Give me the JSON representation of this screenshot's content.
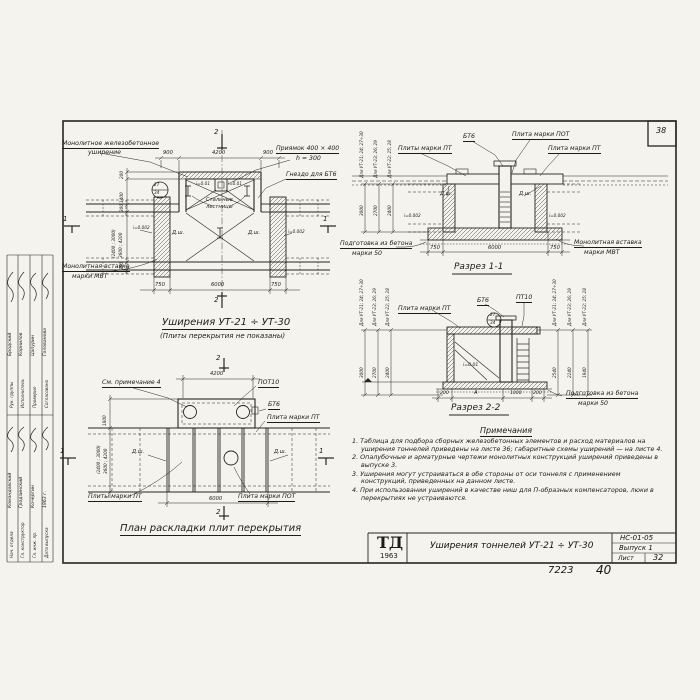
{
  "frame": {
    "corner_number": "38"
  },
  "titleblock": {
    "logo": "ТД",
    "logo_year": "1963",
    "title": "Уширения тоннелей УТ-21 ÷ УТ-30",
    "code": "НС-01-05",
    "issue": "Выпуск 1",
    "sheet_label": "Лист",
    "sheet_number": "32",
    "doc_number": "7223",
    "page_number": "40"
  },
  "stamp": {
    "rows_top": [
      {
        "role": "Рук. группы",
        "name": "Бродский"
      },
      {
        "role": "Исполнитель",
        "name": "Корнилов"
      },
      {
        "role": "Проверил",
        "name": "Цапурин"
      },
      {
        "role": "Согласовано",
        "name": "Голованова"
      }
    ],
    "rows_bottom": [
      {
        "role": "Нач. отдела",
        "name": "Командовский"
      },
      {
        "role": "Гл. конструктор",
        "name": "Гродзинский"
      },
      {
        "role": "Гл. инж. пр.",
        "name": "Кочергин"
      },
      {
        "role": "Дата выпуска",
        "name": "1963 г."
      }
    ]
  },
  "plan_top": {
    "title": "Уширения УТ-21 ÷ УТ-30",
    "subtitle": "(Плиты перекрытия не показаны)",
    "label_widening_1": "Монолитное железобетонное",
    "label_widening_2": "уширение",
    "label_pit_1": "Приямок 400 × 400",
    "label_pit_2": "h = 300",
    "label_socket": "Гнездо для БТ6",
    "label_ladders_1": "Стальные",
    "label_ladders_2": "лестницы",
    "label_insert_1": "Монолитная вставка",
    "label_insert_2": "марки МВТ",
    "detail_num": "27",
    "detail_sheet": "34",
    "slope_pit": "i=0.01",
    "slope": "i=0.002",
    "dsh": "Д.ш.",
    "dim_900": "900",
    "dim_4200": "4200",
    "dim_750": "750",
    "dim_6000": "6000",
    "dim_200": "200",
    "dim_1400": "1400",
    "dim_300": "300",
    "dim_width_1": "(2400 ; 3000)",
    "dim_width_2": "3600 ; 4200",
    "marker_1": "1",
    "marker_2": "2"
  },
  "section_1": {
    "title": "Разрез 1-1",
    "label_bt6": "БТ6",
    "label_pot": "Плита марки ПОТ",
    "label_pt_left": "Плиты марки ПТ",
    "label_pt_right": "Плита марки ПТ",
    "label_prep_1": "Подготовка из бетона",
    "label_prep_2": "марки 50",
    "label_insert_1": "Монолитная вставка",
    "label_insert_2": "марки МВТ",
    "slope": "i=0.002",
    "dsh": "Д.ш.",
    "dims": [
      {
        "label": "Для УТ-21; 24; 27÷30",
        "value": "3000"
      },
      {
        "label": "Для УТ-23; 26; 29",
        "value": "2700"
      },
      {
        "label": "Для УТ-22; 25; 28",
        "value": "2400"
      }
    ],
    "dim_750": "750",
    "dim_6000": "6000"
  },
  "section_2": {
    "title": "Разрез 2-2",
    "label_pt": "Плита марки ПТ",
    "label_bt6": "БТ6",
    "label_pt10": "ПТ10",
    "detail_num": "27",
    "detail_sheet": "34",
    "slope": "i=0.01",
    "label_prep_1": "Подготовка из бетона",
    "label_prep_2": "марки 50",
    "dims_left": [
      {
        "label": "Для УТ-21; 24; 27÷30",
        "value": "3000"
      },
      {
        "label": "Для УТ-23; 26; 29",
        "value": "2700"
      },
      {
        "label": "Для УТ-22; 25; 28",
        "value": "2400"
      }
    ],
    "dims_right": [
      {
        "label": "Для УТ-21; 24; 27÷30",
        "value": "2540"
      },
      {
        "label": "Для УТ-23; 26; 29",
        "value": "2240"
      },
      {
        "label": "Для УТ-22; 25; 28",
        "value": "1940"
      }
    ],
    "dims_bottom": [
      "200",
      "А",
      "1000",
      "200"
    ]
  },
  "plan_bottom": {
    "title": "План раскладки плит перекрытия",
    "label_note": "См. примечание 4",
    "label_pot10": "ПОТ10",
    "label_bt6": "БТ6",
    "label_pt": "Плита марки ПТ",
    "label_pts": "Плиты марки ПТ",
    "label_pot": "Плита марки ПОТ",
    "dsh": "Д.ш.",
    "dim_4200": "4200",
    "dim_6000": "6000",
    "dim_1800": "1800",
    "dim_width_1": "(2400 ; 3000)",
    "dim_width_2": "3600 ; 4200",
    "marker_1": "1",
    "marker_2": "2"
  },
  "notes": {
    "title": "Примечания",
    "items": [
      "1. Таблица для подбора сборных железобетонных элементов и расход материалов на уширения тоннелей приведены на листе 36; габаритные схемы уширений — на листе 4.",
      "2. Опалубочные и арматурные чертежи монолитных конструкций уширений приведены в выпуске 3.",
      "3. Уширения могут устраиваться в обе стороны от оси тоннеля с применением конструкций, приведенных на данном листе.",
      "4. При использовании уширений в качестве ниш для П-образных компенсаторов, люки в перекрытиях не устраиваются."
    ]
  }
}
